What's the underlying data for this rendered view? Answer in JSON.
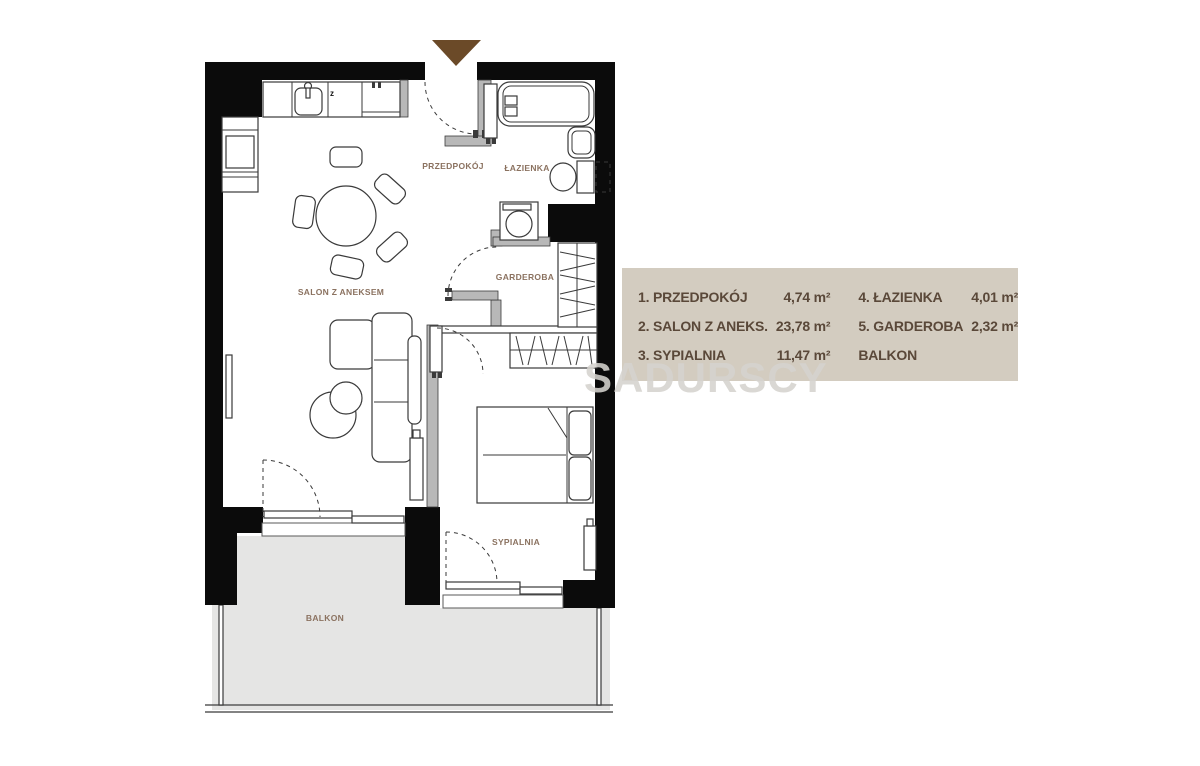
{
  "plan": {
    "labels": {
      "salon": "SALON Z ANEKSEM",
      "przedpokoj": "PRZEDPOKÓJ",
      "lazienka": "ŁAZIENKA",
      "garderoba": "GARDEROBA",
      "sypialnia": "SYPIALNIA",
      "balkon": "BALKON"
    },
    "stove_mark": "z"
  },
  "legend": {
    "items": [
      {
        "label": "1. PRZEDPOKÓJ",
        "area": "4,74 m²"
      },
      {
        "label": "2. SALON Z ANEKS.",
        "area": "23,78 m²"
      },
      {
        "label": "3. SYPIALNIA",
        "area": "11,47 m²"
      },
      {
        "label": "4. ŁAZIENKA",
        "area": "4,01 m²"
      },
      {
        "label": "5. GARDEROBA",
        "area": "2,32 m²"
      },
      {
        "label": "BALKON",
        "area": ""
      }
    ]
  },
  "watermark": "SADURSCY",
  "colors": {
    "wall": "#0b0b0b",
    "partition_wall": "#b8b8b8",
    "balcony_floor": "#e5e5e4",
    "legend_background": "#d3ccc0",
    "legend_text": "#5a4839",
    "room_label_text": "#8b7260",
    "entrance_arrow": "#6b4a28",
    "watermark_text": "rgba(213,211,206,0.88)"
  }
}
